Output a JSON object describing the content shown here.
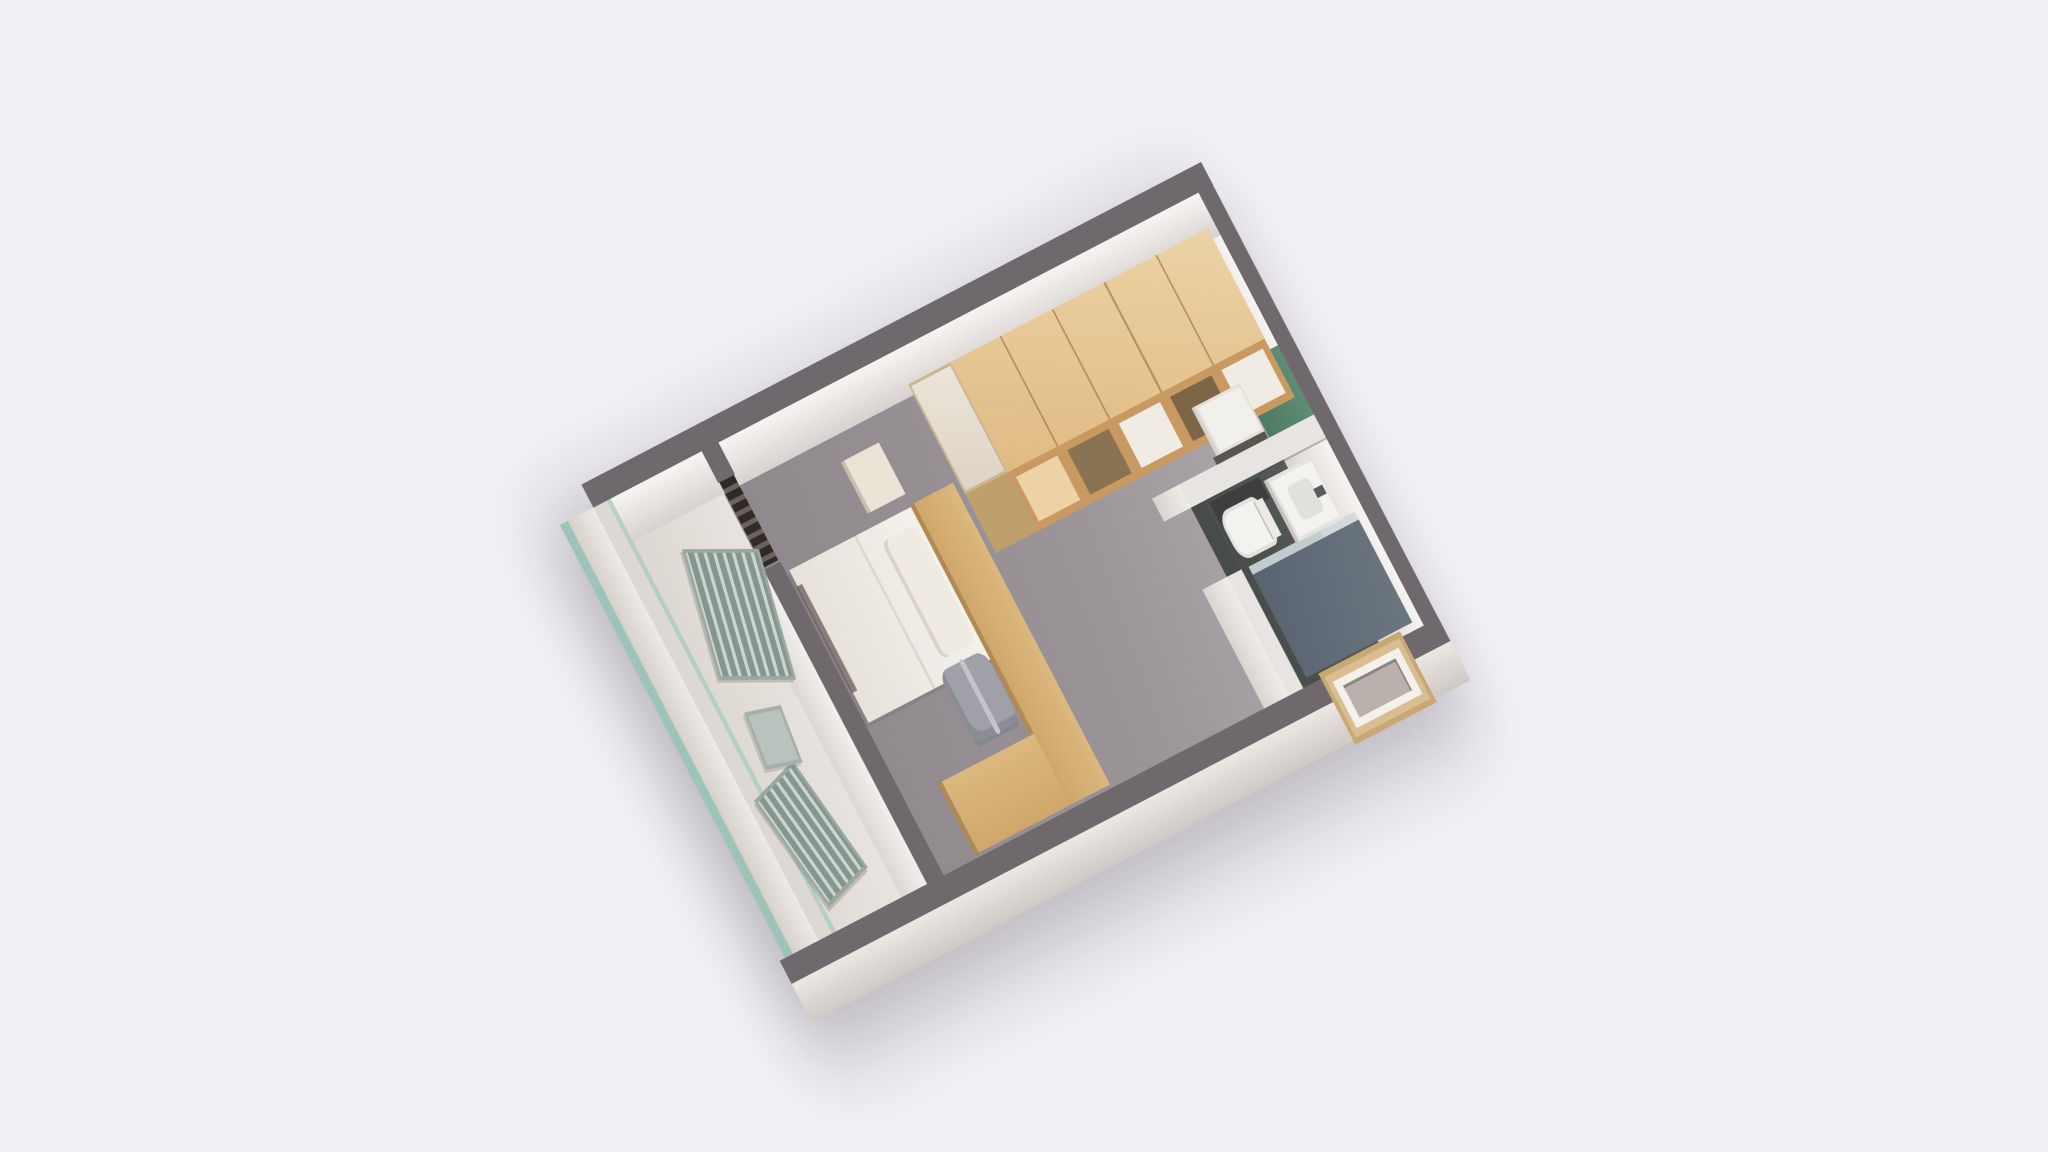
{
  "scene": {
    "type": "3d-floorplan-axonometric-render",
    "background_color": "#f1f0f5",
    "unit_shape": "rectangular studio apartment, long axis rotated toward upper-right",
    "colors": {
      "bg": "#f1f0f5",
      "wall_top": "#6f686c",
      "wall_face": "#f6f4f1",
      "partition_top": "#e7e4e1",
      "floor_main": "#9b9599",
      "floor_balcony": "#ece7e2",
      "bath_floor": "#5d6361",
      "shower_color": "#6b7681",
      "fixture_white": "#f3f2ef",
      "green_panel": "#5e8c74",
      "wood_top": "#ecd2a4",
      "wood_side": "#c89a62",
      "wood_dark": "#7d6647",
      "desk_wood": "#dcb87f",
      "bed_white": "#f5f2ed",
      "chair_gray": "#9fa0a8",
      "lounger_slat": "#85968f",
      "glass_teal": "#9ec4ba",
      "niche_wood": "#d9bd93",
      "dark_detail": "#2f2b29",
      "shadow_color": "rgba(96,90,102,0.38)"
    }
  },
  "rooms": [
    {
      "name": "main-room",
      "floor": "gray carpet"
    },
    {
      "name": "bathroom",
      "floor": "dark gray tile",
      "position": "far end corner"
    },
    {
      "name": "entry-kitchenette-nook",
      "feature": "green wall panel"
    },
    {
      "name": "balcony",
      "floor": "cream",
      "feature": "teal glass balustrade",
      "position": "near end"
    }
  ],
  "furniture": [
    {
      "name": "wardrobe-shelving",
      "material": "light wood",
      "detail": "open cubby compartments",
      "room": "main-room"
    },
    {
      "name": "lower-cabinet",
      "material": "wood with white top",
      "room": "main-room"
    },
    {
      "name": "desk-l-shaped",
      "material": "light wood",
      "room": "main-room"
    },
    {
      "name": "office-chair",
      "color": "gray",
      "room": "main-room"
    },
    {
      "name": "single-bed",
      "detail": "white duvet with pillow, wood headboard",
      "room": "main-room"
    },
    {
      "name": "bedside-cube",
      "color": "pale",
      "room": "main-room"
    },
    {
      "name": "white-appliance",
      "room": "entry-kitchenette-nook"
    },
    {
      "name": "shower-cabin",
      "color": "blue-gray",
      "room": "bathroom"
    },
    {
      "name": "sink-vanity",
      "color": "white",
      "room": "bathroom"
    },
    {
      "name": "toilet",
      "color": "white",
      "room": "bathroom"
    },
    {
      "name": "recessed-window-niche",
      "material": "wood frame",
      "location": "right exterior wall"
    },
    {
      "name": "balcony-door-threshold",
      "detail": "dark track marks",
      "location": "balcony partition"
    },
    {
      "name": "lounge-chair",
      "count": 2,
      "detail": "slatted gray-green",
      "room": "balcony"
    },
    {
      "name": "balcony-side-table",
      "room": "balcony"
    }
  ]
}
